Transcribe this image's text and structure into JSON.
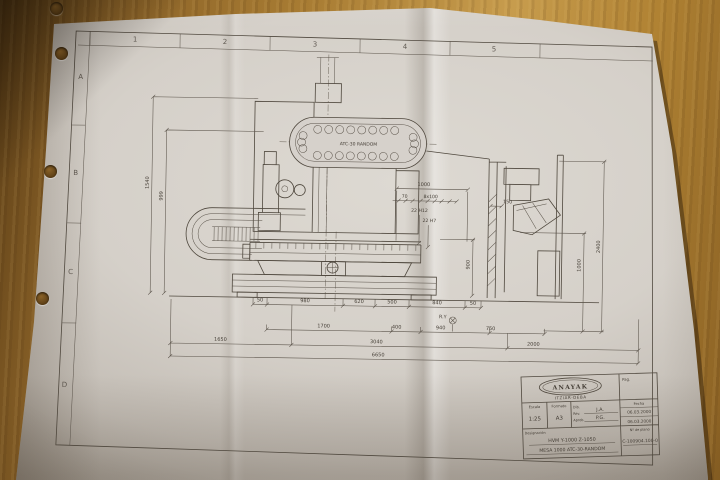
{
  "scene": {
    "description": "Photo of an A3 engineering drawing on a wooden desk",
    "wood_color": "#a87c33",
    "paper_color": "#d5d0c9",
    "ink_color": "#4a4238"
  },
  "drawing": {
    "zone_columns": [
      "1",
      "2",
      "3",
      "4",
      "5"
    ],
    "zone_rows": [
      "A",
      "B",
      "C",
      "D"
    ],
    "atc_label": "ATC-30 RANDOM",
    "ref_marker": "R.Y",
    "dims": {
      "top": [
        "1000",
        "70",
        "8x100",
        "150",
        "22 H12",
        "22 H7"
      ],
      "left_vertical": [
        "1540",
        "999"
      ],
      "right_vertical": [
        "2400",
        "1000",
        "900"
      ],
      "row1": [
        "50",
        "980",
        "620",
        "500",
        "840",
        "50"
      ],
      "row2": [
        "1700",
        "400",
        "940",
        "750"
      ],
      "row3": [
        "1650",
        "3040",
        "2000"
      ],
      "row4": [
        "6650"
      ]
    }
  },
  "title_block": {
    "brand": "ANAYAK",
    "location": "ITZIAR-DEBA",
    "page_label": "Pag.",
    "escala_label": "Escala",
    "escala_value": "1:25",
    "formato_label": "Formato",
    "formato_value": "A3",
    "dib_label": "Dib.",
    "rev_label": "Rev.",
    "aprob_label": "Aprob.",
    "dib_value": "J.A.",
    "aprob_value": "P.G.",
    "fecha_label": "Fecha",
    "fecha_1": "06.03.2000",
    "fecha_2": "06.03.2000",
    "designacion_label": "Designación",
    "designacion_line1": "HVM Y-1000 Z-1050",
    "designacion_line2": "MESA 1000 ATC-30-RANDOM",
    "plano_label": "Nº de plano",
    "plano_value": "C-100904.100-0"
  }
}
